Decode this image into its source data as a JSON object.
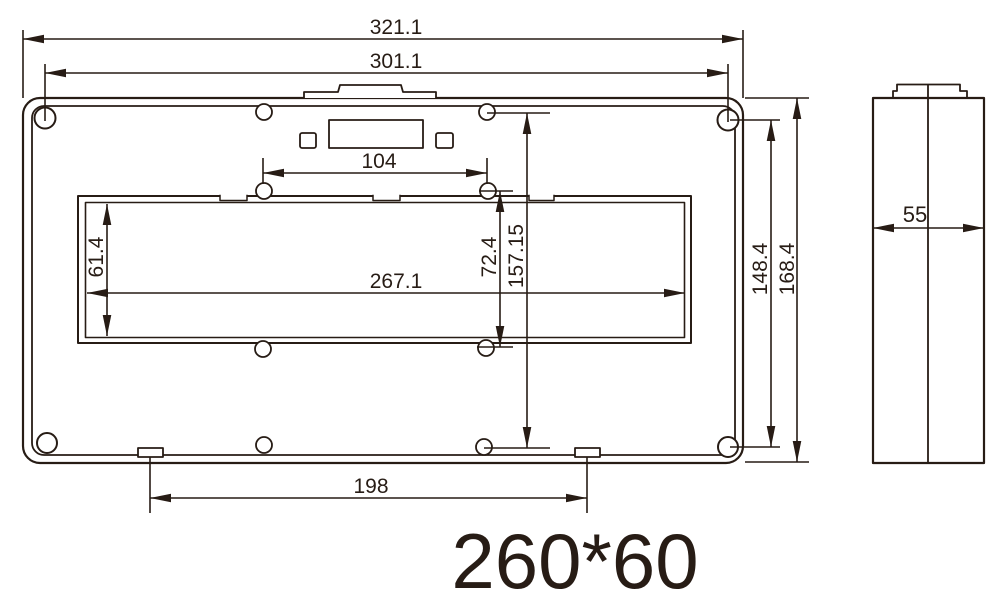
{
  "drawing": {
    "background": "#ffffff",
    "line_color": "#271c15",
    "dimensions": {
      "overall_width": "321.1",
      "mount_hole_width": "301.1",
      "top_hole_spacing": "104",
      "cutout_height": "61.4",
      "cutout_width": "267.1",
      "cutout_hole_spacing_v": "72.4",
      "panel_hole_spacing_v": "157.15",
      "mount_hole_height": "148.4",
      "overall_height": "168.4",
      "bottom_tab_spacing": "198",
      "depth": "55"
    },
    "size_note": "260*60"
  }
}
